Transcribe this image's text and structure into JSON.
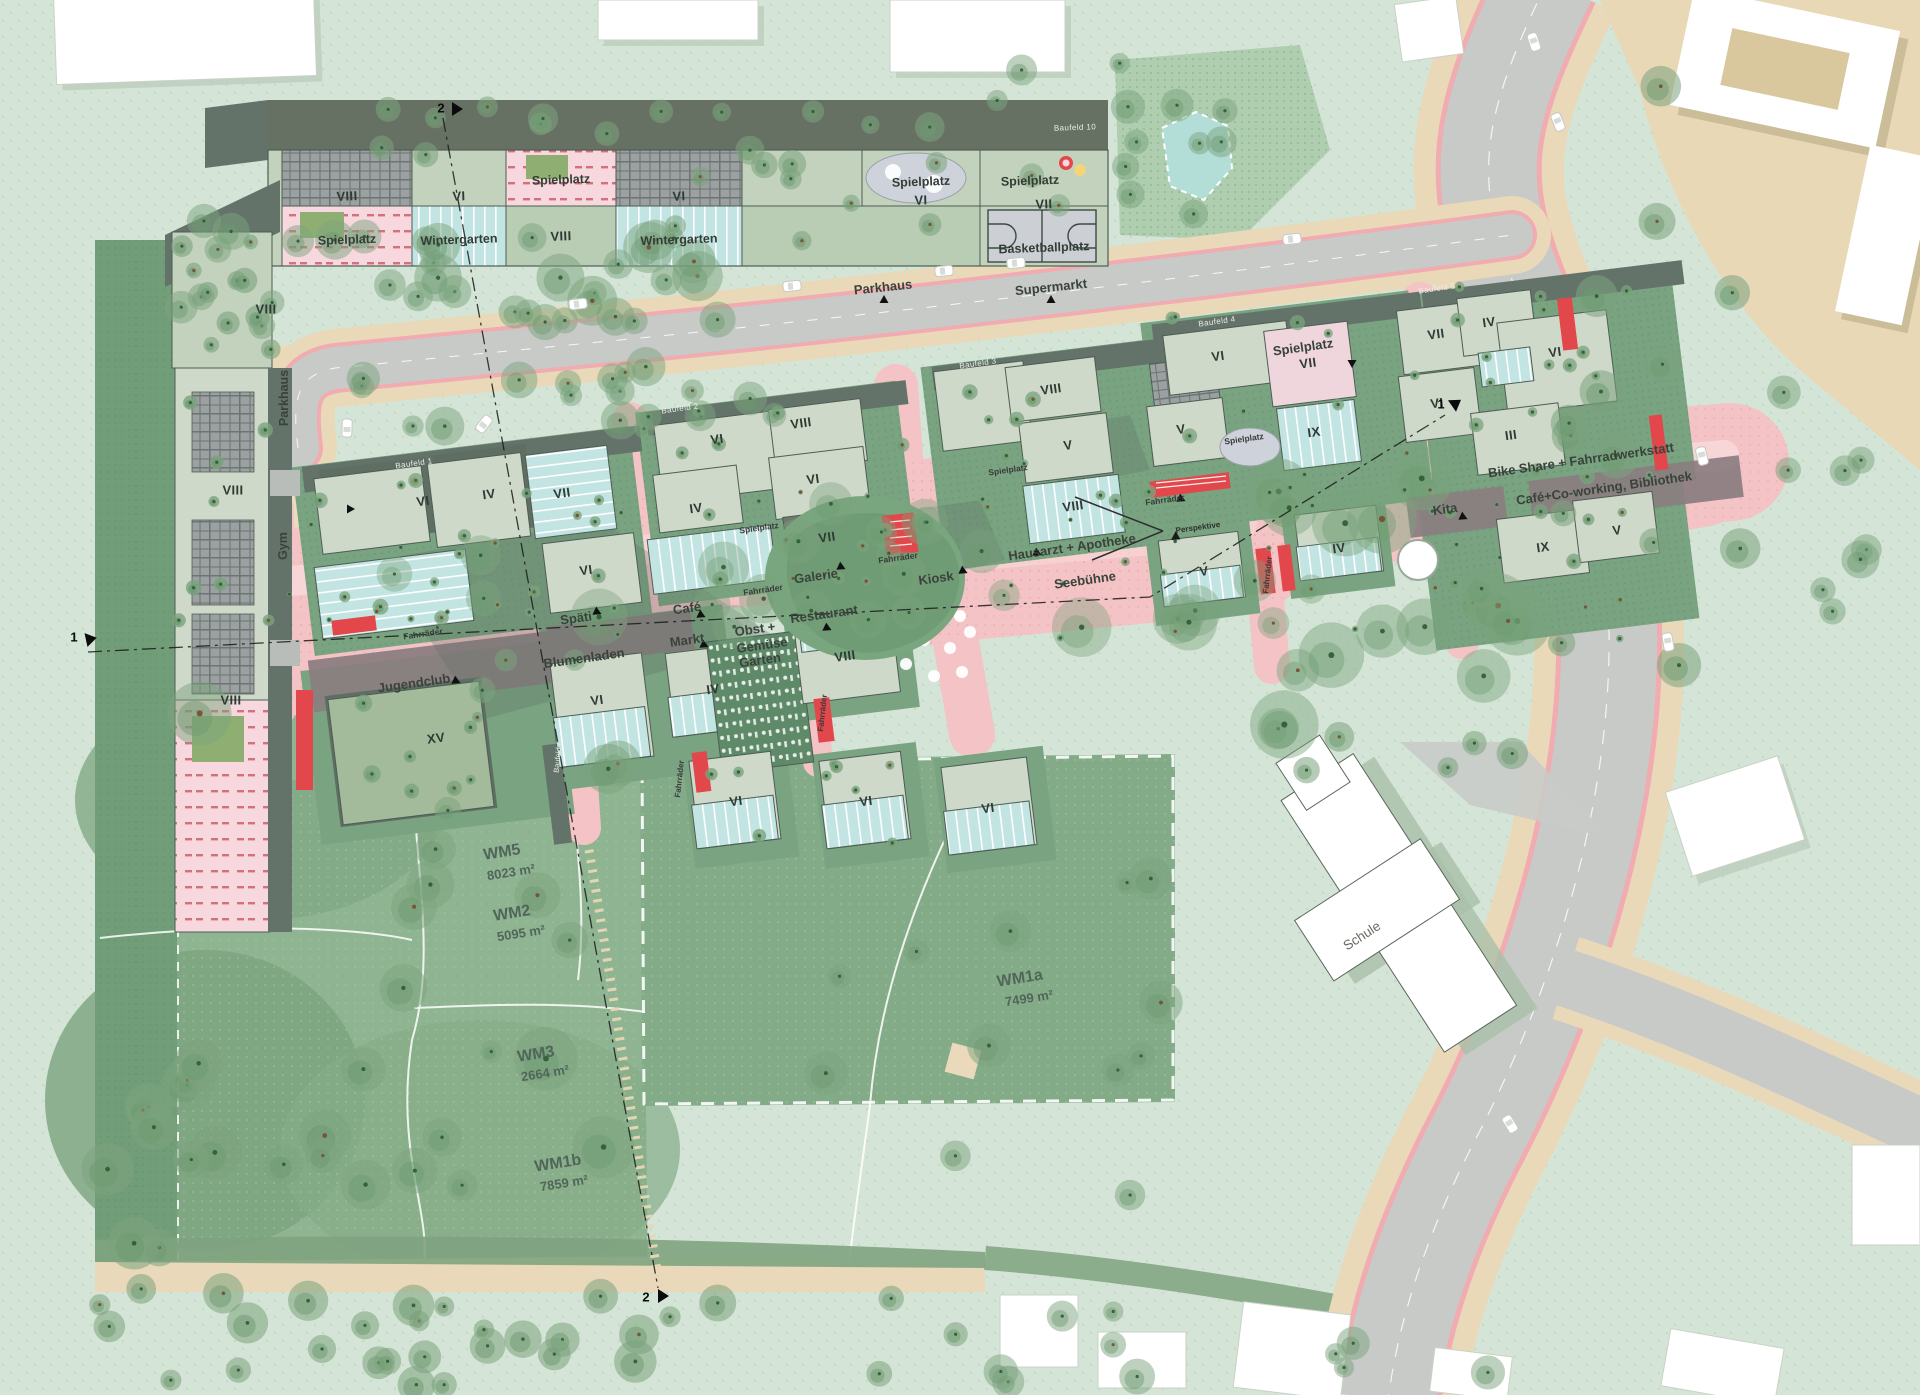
{
  "map": {
    "plan_title": "Wohnquartier Lageplan",
    "palette": {
      "base_green": "#d4e4d6",
      "meadow": "#8fb491",
      "meadow_dark": "#719e79",
      "meadow_wm1a": "#84ab88",
      "block_green": "#79a381",
      "roof_light": "#cfd9ca",
      "roof_dark": "#5f6e63",
      "wintergarten_blue": "#c2e4e2",
      "plaza_pink": "#f4c3c5",
      "plaza_light": "#f8d7d7",
      "accent_red": "#e2474b",
      "road_grey": "#c8cac8",
      "sidewalk_tan": "#ead9b8",
      "context_beige": "#e9d8b6",
      "building_white": "#ffffff",
      "solar_grey": "#9ba1a1",
      "spielplatz_pink": "#f6d8de",
      "spielplatz_grey": "#ced2da",
      "pond_blue": "#b3ded8"
    },
    "labels": [
      {
        "t": "VIII",
        "x": 347,
        "y": 196,
        "c": "numT"
      },
      {
        "t": "Spielplatz",
        "x": 347,
        "y": 240,
        "c": "useT"
      },
      {
        "t": "VI",
        "x": 459,
        "y": 196,
        "c": "numT"
      },
      {
        "t": "Wintergarten",
        "x": 459,
        "y": 240,
        "c": "useT"
      },
      {
        "t": "Spielplatz",
        "x": 561,
        "y": 180,
        "c": "useT"
      },
      {
        "t": "VIII",
        "x": 561,
        "y": 236,
        "c": "numT"
      },
      {
        "t": "VI",
        "x": 679,
        "y": 196,
        "c": "numT"
      },
      {
        "t": "Wintergarten",
        "x": 679,
        "y": 240,
        "c": "useT"
      },
      {
        "t": "Spielplatz",
        "x": 921,
        "y": 182,
        "c": "useT"
      },
      {
        "t": "VI",
        "x": 921,
        "y": 200,
        "c": "numT"
      },
      {
        "t": "Spielplatz",
        "x": 1030,
        "y": 181,
        "c": "useT"
      },
      {
        "t": "VII",
        "x": 1044,
        "y": 204,
        "c": "numT"
      },
      {
        "t": "Basketballplatz",
        "x": 1044,
        "y": 248,
        "c": "useT"
      },
      {
        "t": "Baufeld 10",
        "x": 1075,
        "y": 128,
        "c": "bf",
        "r": -2
      },
      {
        "t": "Parkhaus",
        "x": 883,
        "y": 287,
        "c": "road"
      },
      {
        "t": "Supermarkt",
        "x": 1051,
        "y": 287,
        "c": "road"
      },
      {
        "t": "VIII",
        "x": 266,
        "y": 309,
        "c": "num",
        "r": 0
      },
      {
        "t": "Parkhaus",
        "x": 284,
        "y": 398,
        "c": "roadV"
      },
      {
        "t": "VIII",
        "x": 233,
        "y": 490,
        "c": "num",
        "r": 0
      },
      {
        "t": "Gym",
        "x": 283,
        "y": 546,
        "c": "roadV"
      },
      {
        "t": "VIII",
        "x": 231,
        "y": 700,
        "c": "num",
        "r": 0
      },
      {
        "t": "Baufeld 1",
        "x": 414,
        "y": 464,
        "c": "bf"
      },
      {
        "t": "Baufeld 2",
        "x": 680,
        "y": 409,
        "c": "bf"
      },
      {
        "t": "Baufeld 3",
        "x": 978,
        "y": 364,
        "c": "bf"
      },
      {
        "t": "Baufeld 4",
        "x": 1217,
        "y": 322,
        "c": "bf"
      },
      {
        "t": "Baufeld 5",
        "x": 1437,
        "y": 289,
        "c": "bf"
      },
      {
        "t": "Baufeld 6",
        "x": 558,
        "y": 757,
        "c": "bfV"
      },
      {
        "t": "VI",
        "x": 423,
        "y": 501,
        "c": "num"
      },
      {
        "t": "IV",
        "x": 489,
        "y": 494,
        "c": "num"
      },
      {
        "t": "VII",
        "x": 562,
        "y": 493,
        "c": "num"
      },
      {
        "t": "VI",
        "x": 586,
        "y": 570,
        "c": "num"
      },
      {
        "t": "VI",
        "x": 717,
        "y": 439,
        "c": "num"
      },
      {
        "t": "VIII",
        "x": 801,
        "y": 423,
        "c": "num"
      },
      {
        "t": "IV",
        "x": 696,
        "y": 508,
        "c": "num"
      },
      {
        "t": "VI",
        "x": 813,
        "y": 479,
        "c": "num"
      },
      {
        "t": "VII",
        "x": 827,
        "y": 537,
        "c": "num"
      },
      {
        "t": "VIII",
        "x": 845,
        "y": 656,
        "c": "num"
      },
      {
        "t": "IV",
        "x": 713,
        "y": 689,
        "c": "num"
      },
      {
        "t": "VI",
        "x": 736,
        "y": 801,
        "c": "num"
      },
      {
        "t": "VI",
        "x": 866,
        "y": 801,
        "c": "num"
      },
      {
        "t": "VI",
        "x": 988,
        "y": 808,
        "c": "num"
      },
      {
        "t": "VIII",
        "x": 1051,
        "y": 389,
        "c": "num"
      },
      {
        "t": "V",
        "x": 1068,
        "y": 445,
        "c": "num"
      },
      {
        "t": "VIII",
        "x": 1073,
        "y": 506,
        "c": "num"
      },
      {
        "t": "V",
        "x": 1181,
        "y": 429,
        "c": "num"
      },
      {
        "t": "IX",
        "x": 1314,
        "y": 432,
        "c": "num"
      },
      {
        "t": "V",
        "x": 1204,
        "y": 571,
        "c": "num"
      },
      {
        "t": "IV",
        "x": 1339,
        "y": 548,
        "c": "num"
      },
      {
        "t": "VI",
        "x": 1218,
        "y": 356,
        "c": "num"
      },
      {
        "t": "VII",
        "x": 1308,
        "y": 363,
        "c": "num"
      },
      {
        "t": "VII",
        "x": 1436,
        "y": 334,
        "c": "num"
      },
      {
        "t": "IV",
        "x": 1489,
        "y": 322,
        "c": "num"
      },
      {
        "t": "VI",
        "x": 1555,
        "y": 352,
        "c": "num"
      },
      {
        "t": "VI",
        "x": 1437,
        "y": 403,
        "c": "num"
      },
      {
        "t": "III",
        "x": 1511,
        "y": 435,
        "c": "num"
      },
      {
        "t": "IX",
        "x": 1543,
        "y": 547,
        "c": "num"
      },
      {
        "t": "V",
        "x": 1617,
        "y": 530,
        "c": "num"
      },
      {
        "t": "XV",
        "x": 436,
        "y": 738,
        "c": "num"
      },
      {
        "t": "VI",
        "x": 597,
        "y": 700,
        "c": "num"
      },
      {
        "t": "Café",
        "x": 687,
        "y": 608,
        "c": "useC"
      },
      {
        "t": "Späti",
        "x": 576,
        "y": 618,
        "c": "useC"
      },
      {
        "t": "Markt",
        "x": 687,
        "y": 640,
        "c": "useC"
      },
      {
        "t": "Blumenladen",
        "x": 584,
        "y": 658,
        "c": "useC"
      },
      {
        "t": "Jugendclub",
        "x": 414,
        "y": 683,
        "c": "useC"
      },
      {
        "t": "Galerie",
        "x": 816,
        "y": 576,
        "c": "useC"
      },
      {
        "t": "Kiosk",
        "x": 936,
        "y": 578,
        "c": "useC"
      },
      {
        "t": "Restaurant",
        "x": 824,
        "y": 614,
        "c": "useC"
      },
      {
        "t": "Obst +",
        "x": 755,
        "y": 629,
        "c": "useC"
      },
      {
        "t": "Gemüse",
        "x": 762,
        "y": 645,
        "c": "useC"
      },
      {
        "t": "Garten",
        "x": 760,
        "y": 660,
        "c": "useC"
      },
      {
        "t": "Hausarzt + Apotheke",
        "x": 1072,
        "y": 547,
        "c": "useC"
      },
      {
        "t": "Seebühne",
        "x": 1085,
        "y": 580,
        "c": "useC"
      },
      {
        "t": "Bike Share + Fahrradwerkstatt",
        "x": 1581,
        "y": 460,
        "c": "useC"
      },
      {
        "t": "Café+Co-working, Bibliothek",
        "x": 1604,
        "y": 488,
        "c": "useC"
      },
      {
        "t": "Kita",
        "x": 1445,
        "y": 509,
        "c": "useC"
      },
      {
        "t": "Spielplatz",
        "x": 1303,
        "y": 347,
        "c": "useC"
      },
      {
        "t": "Fahrräder",
        "x": 423,
        "y": 634,
        "c": "tiny"
      },
      {
        "t": "Fahrräder",
        "x": 763,
        "y": 590,
        "c": "tiny"
      },
      {
        "t": "Fahrräder",
        "x": 898,
        "y": 558,
        "c": "tiny"
      },
      {
        "t": "Fahrräder",
        "x": 1165,
        "y": 500,
        "c": "tiny"
      },
      {
        "t": "Fahrräder",
        "x": 680,
        "y": 779,
        "c": "tinyV"
      },
      {
        "t": "Fahrräder",
        "x": 823,
        "y": 713,
        "c": "tinyV"
      },
      {
        "t": "Fahrräder",
        "x": 1268,
        "y": 575,
        "c": "tinyV"
      },
      {
        "t": "Spielplatz",
        "x": 759,
        "y": 528,
        "c": "tiny"
      },
      {
        "t": "Spielplatz",
        "x": 1008,
        "y": 470,
        "c": "tiny"
      },
      {
        "t": "Spielplatz",
        "x": 1244,
        "y": 439,
        "c": "tiny"
      },
      {
        "t": "Perspektive",
        "x": 1198,
        "y": 528,
        "c": "persp"
      },
      {
        "t": "WM5",
        "x": 502,
        "y": 853,
        "c": "wm"
      },
      {
        "t": "8023 m²",
        "x": 511,
        "y": 872,
        "c": "wm2"
      },
      {
        "t": "WM2",
        "x": 512,
        "y": 914,
        "c": "wm"
      },
      {
        "t": "5095 m²",
        "x": 521,
        "y": 933,
        "c": "wm2"
      },
      {
        "t": "WM3",
        "x": 536,
        "y": 1055,
        "c": "wm"
      },
      {
        "t": "2664 m²",
        "x": 545,
        "y": 1073,
        "c": "wm2"
      },
      {
        "t": "WM1b",
        "x": 558,
        "y": 1164,
        "c": "wm"
      },
      {
        "t": "7859 m²",
        "x": 564,
        "y": 1183,
        "c": "wm2"
      },
      {
        "t": "WM1a",
        "x": 1020,
        "y": 979,
        "c": "wm"
      },
      {
        "t": "7499 m²",
        "x": 1029,
        "y": 998,
        "c": "wm2"
      },
      {
        "t": "Schule",
        "x": 1362,
        "y": 936,
        "c": "schule"
      },
      {
        "t": "2",
        "x": 441,
        "y": 108,
        "c": "sec"
      },
      {
        "t": "2",
        "x": 646,
        "y": 1297,
        "c": "sec"
      },
      {
        "t": "1",
        "x": 74,
        "y": 637,
        "c": "sec"
      },
      {
        "t": "1",
        "x": 1441,
        "y": 404,
        "c": "sec"
      }
    ],
    "section_lines": [
      {
        "name": "Schnitt 1",
        "from_marker": "1",
        "to_marker": "1"
      },
      {
        "name": "Schnitt 2",
        "from_marker": "2",
        "to_marker": "2"
      }
    ]
  }
}
